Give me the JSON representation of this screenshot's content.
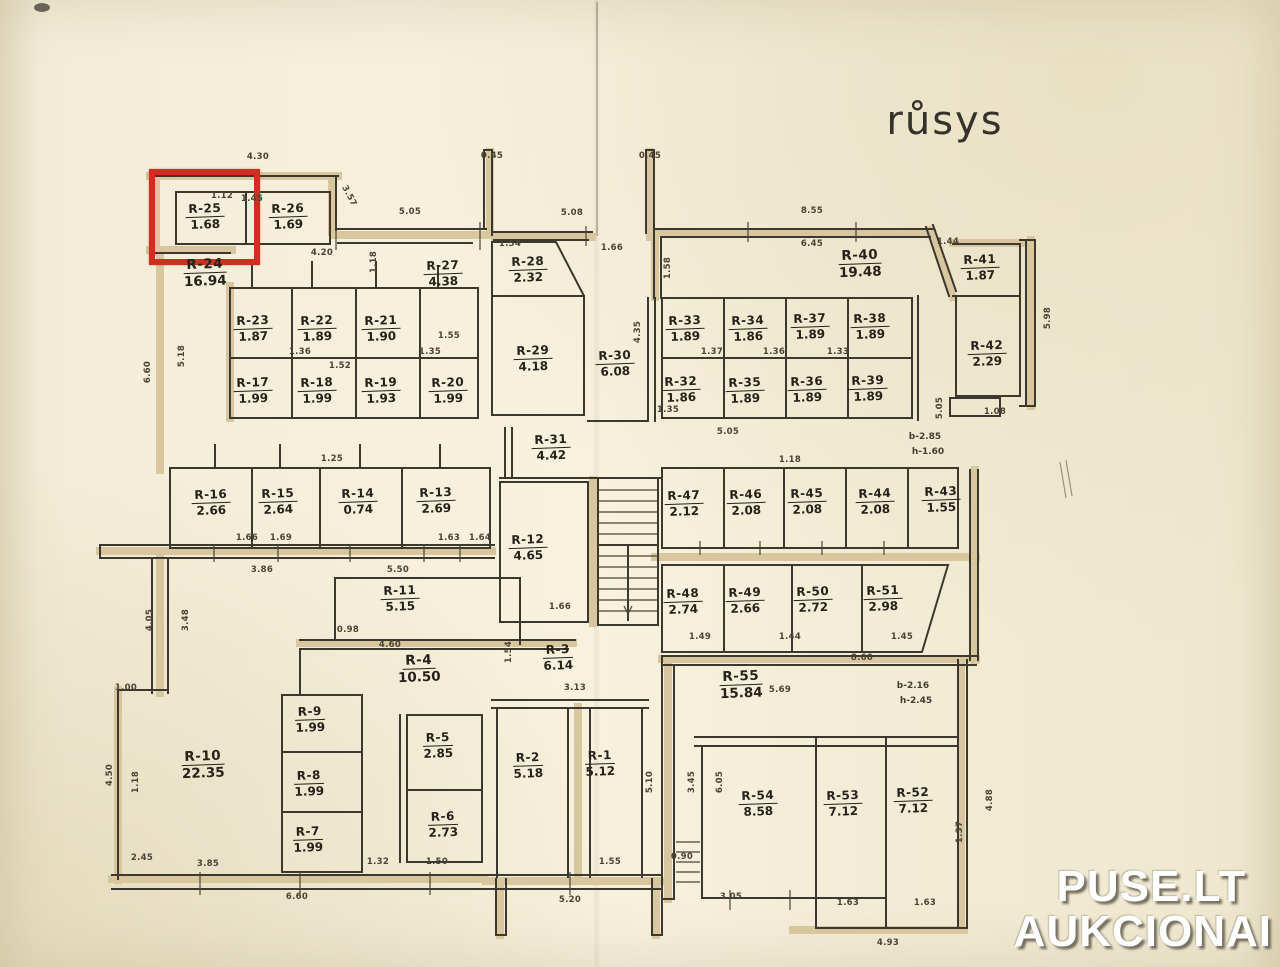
{
  "title": "růsys",
  "watermark": {
    "line1": "PUSE.LT",
    "line2": "AUKCIONAI"
  },
  "highlight": {
    "room": "R-25",
    "color": "#cf2f21"
  },
  "rooms": [
    {
      "id": "R-25",
      "area": "1.68",
      "x": 205,
      "y": 215
    },
    {
      "id": "R-26",
      "area": "1.69",
      "x": 288,
      "y": 215
    },
    {
      "id": "R-24",
      "area": "16.94",
      "x": 205,
      "y": 272,
      "big": true
    },
    {
      "id": "R-27",
      "area": "4.38",
      "x": 443,
      "y": 272
    },
    {
      "id": "R-28",
      "area": "2.32",
      "x": 528,
      "y": 268
    },
    {
      "id": "R-23",
      "area": "1.87",
      "x": 253,
      "y": 327
    },
    {
      "id": "R-22",
      "area": "1.89",
      "x": 317,
      "y": 327
    },
    {
      "id": "R-21",
      "area": "1.90",
      "x": 381,
      "y": 327
    },
    {
      "id": "R-17",
      "area": "1.99",
      "x": 253,
      "y": 389
    },
    {
      "id": "R-18",
      "area": "1.99",
      "x": 317,
      "y": 389
    },
    {
      "id": "R-19",
      "area": "1.93",
      "x": 381,
      "y": 389
    },
    {
      "id": "R-20",
      "area": "1.99",
      "x": 448,
      "y": 389
    },
    {
      "id": "R-29",
      "area": "4.18",
      "x": 533,
      "y": 357
    },
    {
      "id": "R-30",
      "area": "6.08",
      "x": 615,
      "y": 362
    },
    {
      "id": "R-40",
      "area": "19.48",
      "x": 860,
      "y": 263,
      "big": true
    },
    {
      "id": "R-33",
      "area": "1.89",
      "x": 685,
      "y": 327
    },
    {
      "id": "R-34",
      "area": "1.86",
      "x": 748,
      "y": 327
    },
    {
      "id": "R-37",
      "area": "1.89",
      "x": 810,
      "y": 325
    },
    {
      "id": "R-38",
      "area": "1.89",
      "x": 870,
      "y": 325
    },
    {
      "id": "R-32",
      "area": "1.86",
      "x": 681,
      "y": 388
    },
    {
      "id": "R-35",
      "area": "1.89",
      "x": 745,
      "y": 389
    },
    {
      "id": "R-36",
      "area": "1.89",
      "x": 807,
      "y": 388
    },
    {
      "id": "R-39",
      "area": "1.89",
      "x": 868,
      "y": 387
    },
    {
      "id": "R-41",
      "area": "1.87",
      "x": 980,
      "y": 266
    },
    {
      "id": "R-42",
      "area": "2.29",
      "x": 987,
      "y": 352
    },
    {
      "id": "R-31",
      "area": "4.42",
      "x": 551,
      "y": 446
    },
    {
      "id": "R-16",
      "area": "2.66",
      "x": 211,
      "y": 501
    },
    {
      "id": "R-15",
      "area": "2.64",
      "x": 278,
      "y": 500
    },
    {
      "id": "R-14",
      "area": "0.74",
      "x": 358,
      "y": 500
    },
    {
      "id": "R-13",
      "area": "2.69",
      "x": 436,
      "y": 499
    },
    {
      "id": "R-12",
      "area": "4.65",
      "x": 528,
      "y": 546
    },
    {
      "id": "R-47",
      "area": "2.12",
      "x": 684,
      "y": 502
    },
    {
      "id": "R-46",
      "area": "2.08",
      "x": 746,
      "y": 501
    },
    {
      "id": "R-45",
      "area": "2.08",
      "x": 807,
      "y": 500
    },
    {
      "id": "R-44",
      "area": "2.08",
      "x": 875,
      "y": 500
    },
    {
      "id": "R-43",
      "area": "1.55",
      "x": 941,
      "y": 498
    },
    {
      "id": "R-48",
      "area": "2.74",
      "x": 683,
      "y": 600
    },
    {
      "id": "R-49",
      "area": "2.66",
      "x": 745,
      "y": 599
    },
    {
      "id": "R-50",
      "area": "2.72",
      "x": 813,
      "y": 598
    },
    {
      "id": "R-51",
      "area": "2.98",
      "x": 883,
      "y": 597
    },
    {
      "id": "R-11",
      "area": "5.15",
      "x": 400,
      "y": 597
    },
    {
      "id": "R-4",
      "area": "10.50",
      "x": 419,
      "y": 668,
      "big": true
    },
    {
      "id": "R-3",
      "area": "6.14",
      "x": 558,
      "y": 656
    },
    {
      "id": "R-55",
      "area": "15.84",
      "x": 741,
      "y": 684,
      "big": true
    },
    {
      "id": "R-9",
      "area": "1.99",
      "x": 310,
      "y": 718
    },
    {
      "id": "R-5",
      "area": "2.85",
      "x": 438,
      "y": 744
    },
    {
      "id": "R-8",
      "area": "1.99",
      "x": 309,
      "y": 782
    },
    {
      "id": "R-10",
      "area": "22.35",
      "x": 203,
      "y": 764,
      "big": true
    },
    {
      "id": "R-7",
      "area": "1.99",
      "x": 308,
      "y": 838
    },
    {
      "id": "R-6",
      "area": "2.73",
      "x": 443,
      "y": 823
    },
    {
      "id": "R-2",
      "area": "5.18",
      "x": 528,
      "y": 764
    },
    {
      "id": "R-1",
      "area": "5.12",
      "x": 600,
      "y": 762
    },
    {
      "id": "R-54",
      "area": "8.58",
      "x": 758,
      "y": 802
    },
    {
      "id": "R-53",
      "area": "7.12",
      "x": 843,
      "y": 802
    },
    {
      "id": "R-52",
      "area": "7.12",
      "x": 913,
      "y": 799
    }
  ],
  "annotations": [
    {
      "t": "b-2.85",
      "x": 925,
      "y": 437
    },
    {
      "t": "h-1.60",
      "x": 928,
      "y": 452
    },
    {
      "t": "b-2.16",
      "x": 913,
      "y": 686
    },
    {
      "t": "h-2.45",
      "x": 916,
      "y": 701
    }
  ],
  "dimensions": [
    {
      "t": "4.30",
      "x": 258,
      "y": 157,
      "r": 0
    },
    {
      "t": "1.12",
      "x": 222,
      "y": 196,
      "r": 0
    },
    {
      "t": "1.45",
      "x": 252,
      "y": 199,
      "r": 0
    },
    {
      "t": "3.57",
      "x": 349,
      "y": 196,
      "r": 62
    },
    {
      "t": "5.05",
      "x": 410,
      "y": 212,
      "r": 0
    },
    {
      "t": "0.45",
      "x": 492,
      "y": 156,
      "r": 0
    },
    {
      "t": "5.08",
      "x": 572,
      "y": 213,
      "r": 0
    },
    {
      "t": "0.45",
      "x": 650,
      "y": 156,
      "r": 0
    },
    {
      "t": "8.55",
      "x": 812,
      "y": 211,
      "r": 0
    },
    {
      "t": "6.45",
      "x": 812,
      "y": 244,
      "r": 0
    },
    {
      "t": "1.44",
      "x": 948,
      "y": 242,
      "r": 0
    },
    {
      "t": "1.54",
      "x": 510,
      "y": 244,
      "r": 0
    },
    {
      "t": "1.66",
      "x": 612,
      "y": 248,
      "r": 0
    },
    {
      "t": "4.20",
      "x": 322,
      "y": 253,
      "r": 0
    },
    {
      "t": "1.18",
      "x": 374,
      "y": 262,
      "r": -90
    },
    {
      "t": "1.58",
      "x": 668,
      "y": 268,
      "r": -90
    },
    {
      "t": "5.98",
      "x": 1048,
      "y": 318,
      "r": -90
    },
    {
      "t": "6.60",
      "x": 148,
      "y": 372,
      "r": -90
    },
    {
      "t": "5.18",
      "x": 182,
      "y": 356,
      "r": -90
    },
    {
      "t": "4.35",
      "x": 638,
      "y": 332,
      "r": -90
    },
    {
      "t": "1.25",
      "x": 332,
      "y": 459,
      "r": 0
    },
    {
      "t": "5.05",
      "x": 728,
      "y": 432,
      "r": 0
    },
    {
      "t": "1.18",
      "x": 790,
      "y": 460,
      "r": 0
    },
    {
      "t": "1.08",
      "x": 995,
      "y": 412,
      "r": 0
    },
    {
      "t": "5.05",
      "x": 940,
      "y": 408,
      "r": -90
    },
    {
      "t": "3.86",
      "x": 262,
      "y": 570,
      "r": 0
    },
    {
      "t": "5.50",
      "x": 398,
      "y": 570,
      "r": 0
    },
    {
      "t": "8.60",
      "x": 862,
      "y": 658,
      "r": 0
    },
    {
      "t": "0.98",
      "x": 348,
      "y": 630,
      "r": 0
    },
    {
      "t": "4.60",
      "x": 390,
      "y": 645,
      "r": 0
    },
    {
      "t": "1.54",
      "x": 509,
      "y": 652,
      "r": -90
    },
    {
      "t": "3.13",
      "x": 575,
      "y": 688,
      "r": 0
    },
    {
      "t": "4.05",
      "x": 150,
      "y": 620,
      "r": -90
    },
    {
      "t": "3.48",
      "x": 186,
      "y": 620,
      "r": -90
    },
    {
      "t": "1.00",
      "x": 126,
      "y": 688,
      "r": 0
    },
    {
      "t": "4.50",
      "x": 110,
      "y": 775,
      "r": -90
    },
    {
      "t": "1.18",
      "x": 136,
      "y": 782,
      "r": -90
    },
    {
      "t": "2.45",
      "x": 142,
      "y": 858,
      "r": 0
    },
    {
      "t": "3.85",
      "x": 208,
      "y": 864,
      "r": 0
    },
    {
      "t": "6.60",
      "x": 297,
      "y": 897,
      "r": 0
    },
    {
      "t": "1.32",
      "x": 378,
      "y": 862,
      "r": 0
    },
    {
      "t": "1.50",
      "x": 437,
      "y": 862,
      "r": 0
    },
    {
      "t": "1.55",
      "x": 610,
      "y": 862,
      "r": 0
    },
    {
      "t": "5.20",
      "x": 570,
      "y": 900,
      "r": 0
    },
    {
      "t": "0.90",
      "x": 682,
      "y": 857,
      "r": 0
    },
    {
      "t": "3.05",
      "x": 731,
      "y": 897,
      "r": 0
    },
    {
      "t": "1.63",
      "x": 848,
      "y": 903,
      "r": 0
    },
    {
      "t": "1.63",
      "x": 925,
      "y": 903,
      "r": 0
    },
    {
      "t": "4.93",
      "x": 888,
      "y": 943,
      "r": 0
    },
    {
      "t": "4.88",
      "x": 990,
      "y": 800,
      "r": -90
    },
    {
      "t": "1.37",
      "x": 960,
      "y": 832,
      "r": -90
    },
    {
      "t": "5.10",
      "x": 650,
      "y": 782,
      "r": -90
    },
    {
      "t": "3.45",
      "x": 692,
      "y": 782,
      "r": -90
    },
    {
      "t": "6.05",
      "x": 720,
      "y": 782,
      "r": -90
    },
    {
      "t": "5.69",
      "x": 780,
      "y": 690,
      "r": 0
    },
    {
      "t": "1.36",
      "x": 300,
      "y": 352,
      "r": 0
    },
    {
      "t": "1.52",
      "x": 340,
      "y": 366,
      "r": 0
    },
    {
      "t": "1.35",
      "x": 430,
      "y": 352,
      "r": 0
    },
    {
      "t": "1.55",
      "x": 449,
      "y": 336,
      "r": 0
    },
    {
      "t": "1.37",
      "x": 712,
      "y": 352,
      "r": 0
    },
    {
      "t": "1.36",
      "x": 774,
      "y": 352,
      "r": 0
    },
    {
      "t": "1.33",
      "x": 838,
      "y": 352,
      "r": 0
    },
    {
      "t": "1.35",
      "x": 668,
      "y": 410,
      "r": 0
    },
    {
      "t": "1.66",
      "x": 247,
      "y": 538,
      "r": 0
    },
    {
      "t": "1.69",
      "x": 281,
      "y": 538,
      "r": 0
    },
    {
      "t": "1.63",
      "x": 449,
      "y": 538,
      "r": 0
    },
    {
      "t": "1.64",
      "x": 480,
      "y": 538,
      "r": 0
    },
    {
      "t": "1.66",
      "x": 560,
      "y": 607,
      "r": 0
    },
    {
      "t": "1.49",
      "x": 700,
      "y": 637,
      "r": 0
    },
    {
      "t": "1.44",
      "x": 790,
      "y": 637,
      "r": 0
    },
    {
      "t": "1.45",
      "x": 902,
      "y": 637,
      "r": 0
    }
  ]
}
